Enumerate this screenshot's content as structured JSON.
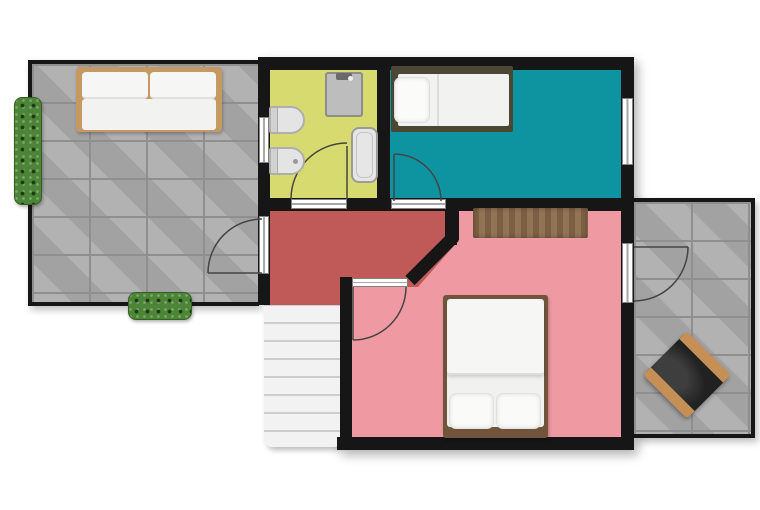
{
  "meta": {
    "type": "floor-plan",
    "canvas": {
      "width": 760,
      "height": 510
    }
  },
  "colors": {
    "wall": "#161616",
    "terrace_tile": "#ababab",
    "bathroom_floor": "#d7db6f",
    "small_bedroom_floor": "#0e94a1",
    "hallway_floor": "#bf5a58",
    "main_bedroom_floor": "#ef9aa3",
    "stairs": "#f2f2f2",
    "sofa_frame": "#c49a62",
    "single_bed_frame": "#4a4734",
    "double_bed_frame": "#70543c",
    "rug": "#8a6a4a",
    "armchair_seat": "#212121",
    "armchair_wood": "#c68f55",
    "plant": "#4c8438",
    "fixture": "#e4e4e4",
    "opening_white": "#ffffff",
    "door_stroke": "#444444"
  },
  "rooms": [
    {
      "id": "left-terrace",
      "kind": "terrace",
      "floor": "gray pavers"
    },
    {
      "id": "bathroom",
      "kind": "bathroom",
      "floor": "yellow-green"
    },
    {
      "id": "small-bedroom",
      "kind": "bedroom",
      "floor": "teal"
    },
    {
      "id": "hallway",
      "kind": "hallway",
      "floor": "dark red"
    },
    {
      "id": "main-bedroom",
      "kind": "bedroom",
      "floor": "pink"
    },
    {
      "id": "right-terrace",
      "kind": "terrace",
      "floor": "gray pavers"
    }
  ],
  "doors": [
    {
      "id": "terrace-door",
      "between": [
        "hallway",
        "left-terrace"
      ],
      "swing": "into terrace"
    },
    {
      "id": "bathroom-door",
      "between": [
        "hallway",
        "bathroom"
      ],
      "swing": "into bathroom"
    },
    {
      "id": "small-bedroom-door",
      "between": [
        "hallway",
        "small-bedroom"
      ],
      "swing": "into bedroom"
    },
    {
      "id": "main-bedroom-door",
      "between": [
        "hallway",
        "main-bedroom"
      ],
      "swing": "into bedroom"
    },
    {
      "id": "right-terrace-door",
      "between": [
        "main-bedroom",
        "right-terrace"
      ],
      "swing": "into terrace"
    }
  ],
  "windows": [
    {
      "id": "bathroom-window",
      "wall": "west"
    },
    {
      "id": "small-bedroom-window",
      "wall": "east"
    }
  ],
  "staircase": {
    "steps": 8,
    "position": "south of hallway"
  },
  "furniture": [
    {
      "id": "sofa",
      "room": "left-terrace"
    },
    {
      "id": "wall-planter",
      "room": "left-terrace"
    },
    {
      "id": "hedge-planter",
      "room": "left-terrace"
    },
    {
      "id": "shower-unit",
      "room": "bathroom"
    },
    {
      "id": "toilet",
      "room": "bathroom"
    },
    {
      "id": "bidet",
      "room": "bathroom"
    },
    {
      "id": "bathtub",
      "room": "bathroom"
    },
    {
      "id": "single-bed",
      "room": "small-bedroom"
    },
    {
      "id": "rug",
      "room": "main-bedroom"
    },
    {
      "id": "double-bed",
      "room": "main-bedroom"
    },
    {
      "id": "armchair",
      "room": "right-terrace"
    }
  ]
}
